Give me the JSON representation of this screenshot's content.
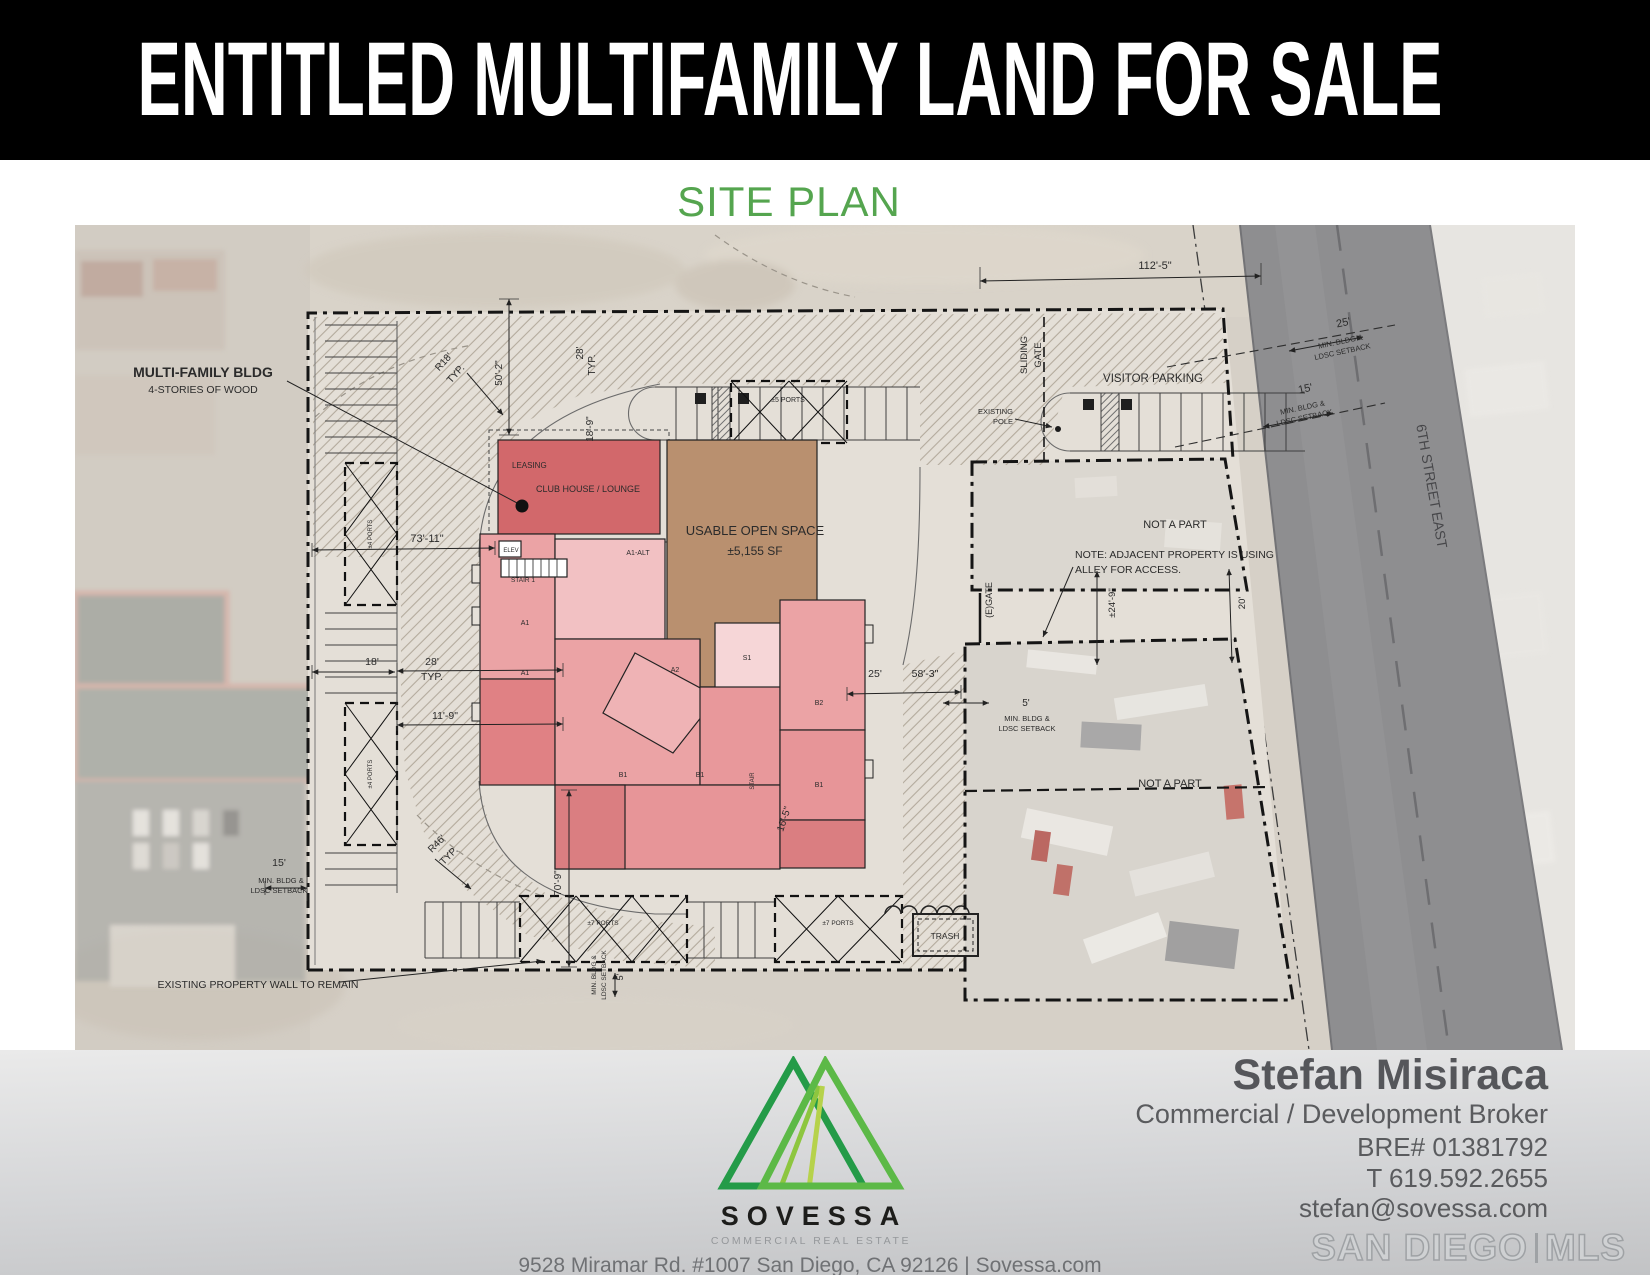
{
  "header": {
    "title": "ENTITLED MULTIFAMILY LAND FOR SALE"
  },
  "section_heading": {
    "text": "SITE PLAN"
  },
  "site_plan": {
    "annotations": [
      {
        "text": "MULTI-FAMILY BLDG",
        "x": 128,
        "y": 152,
        "size": 14,
        "weight": 700
      },
      {
        "text": "4-STORIES OF WOOD",
        "x": 128,
        "y": 168,
        "size": 10.5
      },
      {
        "text": "R18'",
        "x": 371,
        "y": 139,
        "size": 10,
        "rot": -48
      },
      {
        "text": "TYP.",
        "x": 383,
        "y": 151,
        "size": 10,
        "rot": -48
      },
      {
        "text": "50'-2\"",
        "x": 427,
        "y": 148,
        "size": 10,
        "rot": -90
      },
      {
        "text": "28'",
        "x": 508,
        "y": 128,
        "size": 10,
        "rot": -90
      },
      {
        "text": "TYP.",
        "x": 520,
        "y": 140,
        "size": 10,
        "rot": -90
      },
      {
        "text": "18'-9\"",
        "x": 518,
        "y": 204,
        "size": 10,
        "rot": -90
      },
      {
        "text": "LEASING",
        "x": 437,
        "y": 243,
        "size": 8,
        "anchor": "start"
      },
      {
        "text": "CLUB HOUSE / LOUNGE",
        "x": 513,
        "y": 267,
        "size": 9
      },
      {
        "text": "USABLE OPEN SPACE",
        "x": 680,
        "y": 310,
        "size": 13
      },
      {
        "text": "±5,155 SF",
        "x": 680,
        "y": 330,
        "size": 12
      },
      {
        "text": "73'-11\"",
        "x": 352,
        "y": 317,
        "size": 11
      },
      {
        "text": "112'-5\"",
        "x": 1080,
        "y": 44,
        "size": 11
      },
      {
        "text": "SLIDING",
        "x": 952,
        "y": 130,
        "size": 9.5,
        "rot": -90
      },
      {
        "text": "GATE",
        "x": 966,
        "y": 130,
        "size": 9.5,
        "rot": -90
      },
      {
        "text": "VISITOR PARKING",
        "x": 1078,
        "y": 157,
        "size": 11.5
      },
      {
        "text": "EXISTING",
        "x": 938,
        "y": 189,
        "size": 7.5,
        "anchor": "end"
      },
      {
        "text": "POLE",
        "x": 938,
        "y": 199,
        "size": 7.5,
        "anchor": "end"
      },
      {
        "text": "25'",
        "x": 1269,
        "y": 101,
        "size": 11,
        "rot": -12
      },
      {
        "text": "MIN. BLDG &",
        "x": 1266,
        "y": 119,
        "size": 7.5,
        "rot": -12
      },
      {
        "text": "LDSC SETBACK",
        "x": 1268,
        "y": 129,
        "size": 7.5,
        "rot": -12
      },
      {
        "text": "15'",
        "x": 1231,
        "y": 167,
        "size": 11,
        "rot": -12
      },
      {
        "text": "MIN. BLDG &",
        "x": 1228,
        "y": 185,
        "size": 7.5,
        "rot": -12
      },
      {
        "text": "LDSC SETBACK",
        "x": 1230,
        "y": 195,
        "size": 7.5,
        "rot": -12
      },
      {
        "text": "6TH STREET EAST",
        "x": 1352,
        "y": 262,
        "size": 14,
        "rot": 80,
        "color": "#47474a"
      },
      {
        "text": "NOT A PART",
        "x": 1100,
        "y": 303,
        "size": 11
      },
      {
        "text": "NOTE: ADJACENT PROPERTY IS USING",
        "x": 1000,
        "y": 333,
        "size": 10.5,
        "anchor": "start"
      },
      {
        "text": "ALLEY FOR ACCESS.",
        "x": 1000,
        "y": 348,
        "size": 10.5,
        "anchor": "start"
      },
      {
        "text": "(E)GATE",
        "x": 917,
        "y": 375,
        "size": 9,
        "rot": -90
      },
      {
        "text": "±24'-9\"",
        "x": 1040,
        "y": 378,
        "size": 9.5,
        "rot": -90
      },
      {
        "text": "20'",
        "x": 1170,
        "y": 378,
        "size": 9.5,
        "rot": -90
      },
      {
        "text": "18'",
        "x": 297,
        "y": 440,
        "size": 10.5
      },
      {
        "text": "28'",
        "x": 357,
        "y": 440,
        "size": 10.5
      },
      {
        "text": "TYP.",
        "x": 357,
        "y": 455,
        "size": 10.5
      },
      {
        "text": "11'-9\"",
        "x": 370,
        "y": 494,
        "size": 10.5
      },
      {
        "text": "25'",
        "x": 800,
        "y": 452,
        "size": 10.5
      },
      {
        "text": "58'-3\"",
        "x": 850,
        "y": 452,
        "size": 10.5
      },
      {
        "text": "5'",
        "x": 951,
        "y": 481,
        "size": 10
      },
      {
        "text": "MIN. BLDG &",
        "x": 952,
        "y": 496,
        "size": 7.5
      },
      {
        "text": "LDSC SETBACK",
        "x": 952,
        "y": 506,
        "size": 7.5
      },
      {
        "text": "NOT A PART",
        "x": 1095,
        "y": 562,
        "size": 11
      },
      {
        "text": "15'",
        "x": 204,
        "y": 641,
        "size": 10.5
      },
      {
        "text": "MIN. BLDG &",
        "x": 206,
        "y": 658,
        "size": 7.5
      },
      {
        "text": "LDSC SETBACK",
        "x": 204,
        "y": 668,
        "size": 7.5
      },
      {
        "text": "R46'",
        "x": 364,
        "y": 621,
        "size": 10,
        "rot": -45
      },
      {
        "text": "TYP.",
        "x": 376,
        "y": 633,
        "size": 10,
        "rot": -45
      },
      {
        "text": "70'-9\"",
        "x": 486,
        "y": 658,
        "size": 10,
        "rot": -90
      },
      {
        "text": "16'-5\"",
        "x": 712,
        "y": 595,
        "size": 10,
        "rot": -72
      },
      {
        "text": "±5 PORTS",
        "x": 713,
        "y": 177,
        "size": 7
      },
      {
        "text": "±7 PORTS",
        "x": 528,
        "y": 700,
        "size": 6.5
      },
      {
        "text": "±7 PORTS",
        "x": 763,
        "y": 700,
        "size": 6.5
      },
      {
        "text": "±4 PORTS",
        "x": 297,
        "y": 309,
        "size": 6,
        "rot": -90
      },
      {
        "text": "±4 PORTS",
        "x": 297,
        "y": 549,
        "size": 6,
        "rot": -90
      },
      {
        "text": "TRASH",
        "x": 870,
        "y": 714,
        "size": 8.5
      },
      {
        "text": "MIN. BLDG &",
        "x": 521,
        "y": 750,
        "size": 6.5,
        "rot": -90
      },
      {
        "text": "LDSC SETBACK",
        "x": 531,
        "y": 750,
        "size": 6.5,
        "rot": -90
      },
      {
        "text": "5'",
        "x": 548,
        "y": 752,
        "size": 9,
        "rot": -90
      },
      {
        "text": "EXISTING PROPERTY WALL TO REMAIN",
        "x": 183,
        "y": 763,
        "size": 10.5
      },
      {
        "text": "ELEV",
        "x": 436,
        "y": 327,
        "size": 6
      },
      {
        "text": "STAIR 1",
        "x": 448,
        "y": 357,
        "size": 6.5
      },
      {
        "text": "STAIR",
        "x": 679,
        "y": 556,
        "size": 6,
        "rot": -90
      },
      {
        "text": "A1-ALT",
        "x": 563,
        "y": 330,
        "size": 7
      },
      {
        "text": "A1",
        "x": 450,
        "y": 400,
        "size": 7
      },
      {
        "text": "A1",
        "x": 450,
        "y": 450,
        "size": 7
      },
      {
        "text": "A2",
        "x": 600,
        "y": 447,
        "size": 7
      },
      {
        "text": "S1",
        "x": 672,
        "y": 435,
        "size": 7
      },
      {
        "text": "B1",
        "x": 548,
        "y": 552,
        "size": 7
      },
      {
        "text": "B1",
        "x": 625,
        "y": 552,
        "size": 7
      },
      {
        "text": "B2",
        "x": 744,
        "y": 480,
        "size": 7
      },
      {
        "text": "B1",
        "x": 744,
        "y": 562,
        "size": 7
      }
    ]
  },
  "footer": {
    "company": {
      "name": "SOVESSA",
      "tagline": "COMMERCIAL REAL ESTATE",
      "address_line": "9528 Miramar Rd. #1007 San Diego, CA 92126  |  Sovessa.com"
    },
    "broker": {
      "name": "Stefan Misiraca",
      "title": "Commercial / Development Broker",
      "license": "BRE# 01381792",
      "phone": "T 619.592.2655",
      "email": "stefan@sovessa.com"
    },
    "mls": {
      "name_left": "SAN DIEGO",
      "name_right": "MLS"
    }
  },
  "colors": {
    "header_bg": "#000000",
    "heading_green": "#55a54f",
    "logo_green_dark": "#249b48",
    "logo_green_light": "#5cb947",
    "logo_lime": "#8dc63f",
    "clubhouse_red": "#d2686b",
    "open_space_tan": "#b9906f",
    "road_gray": "#8e8e90"
  }
}
